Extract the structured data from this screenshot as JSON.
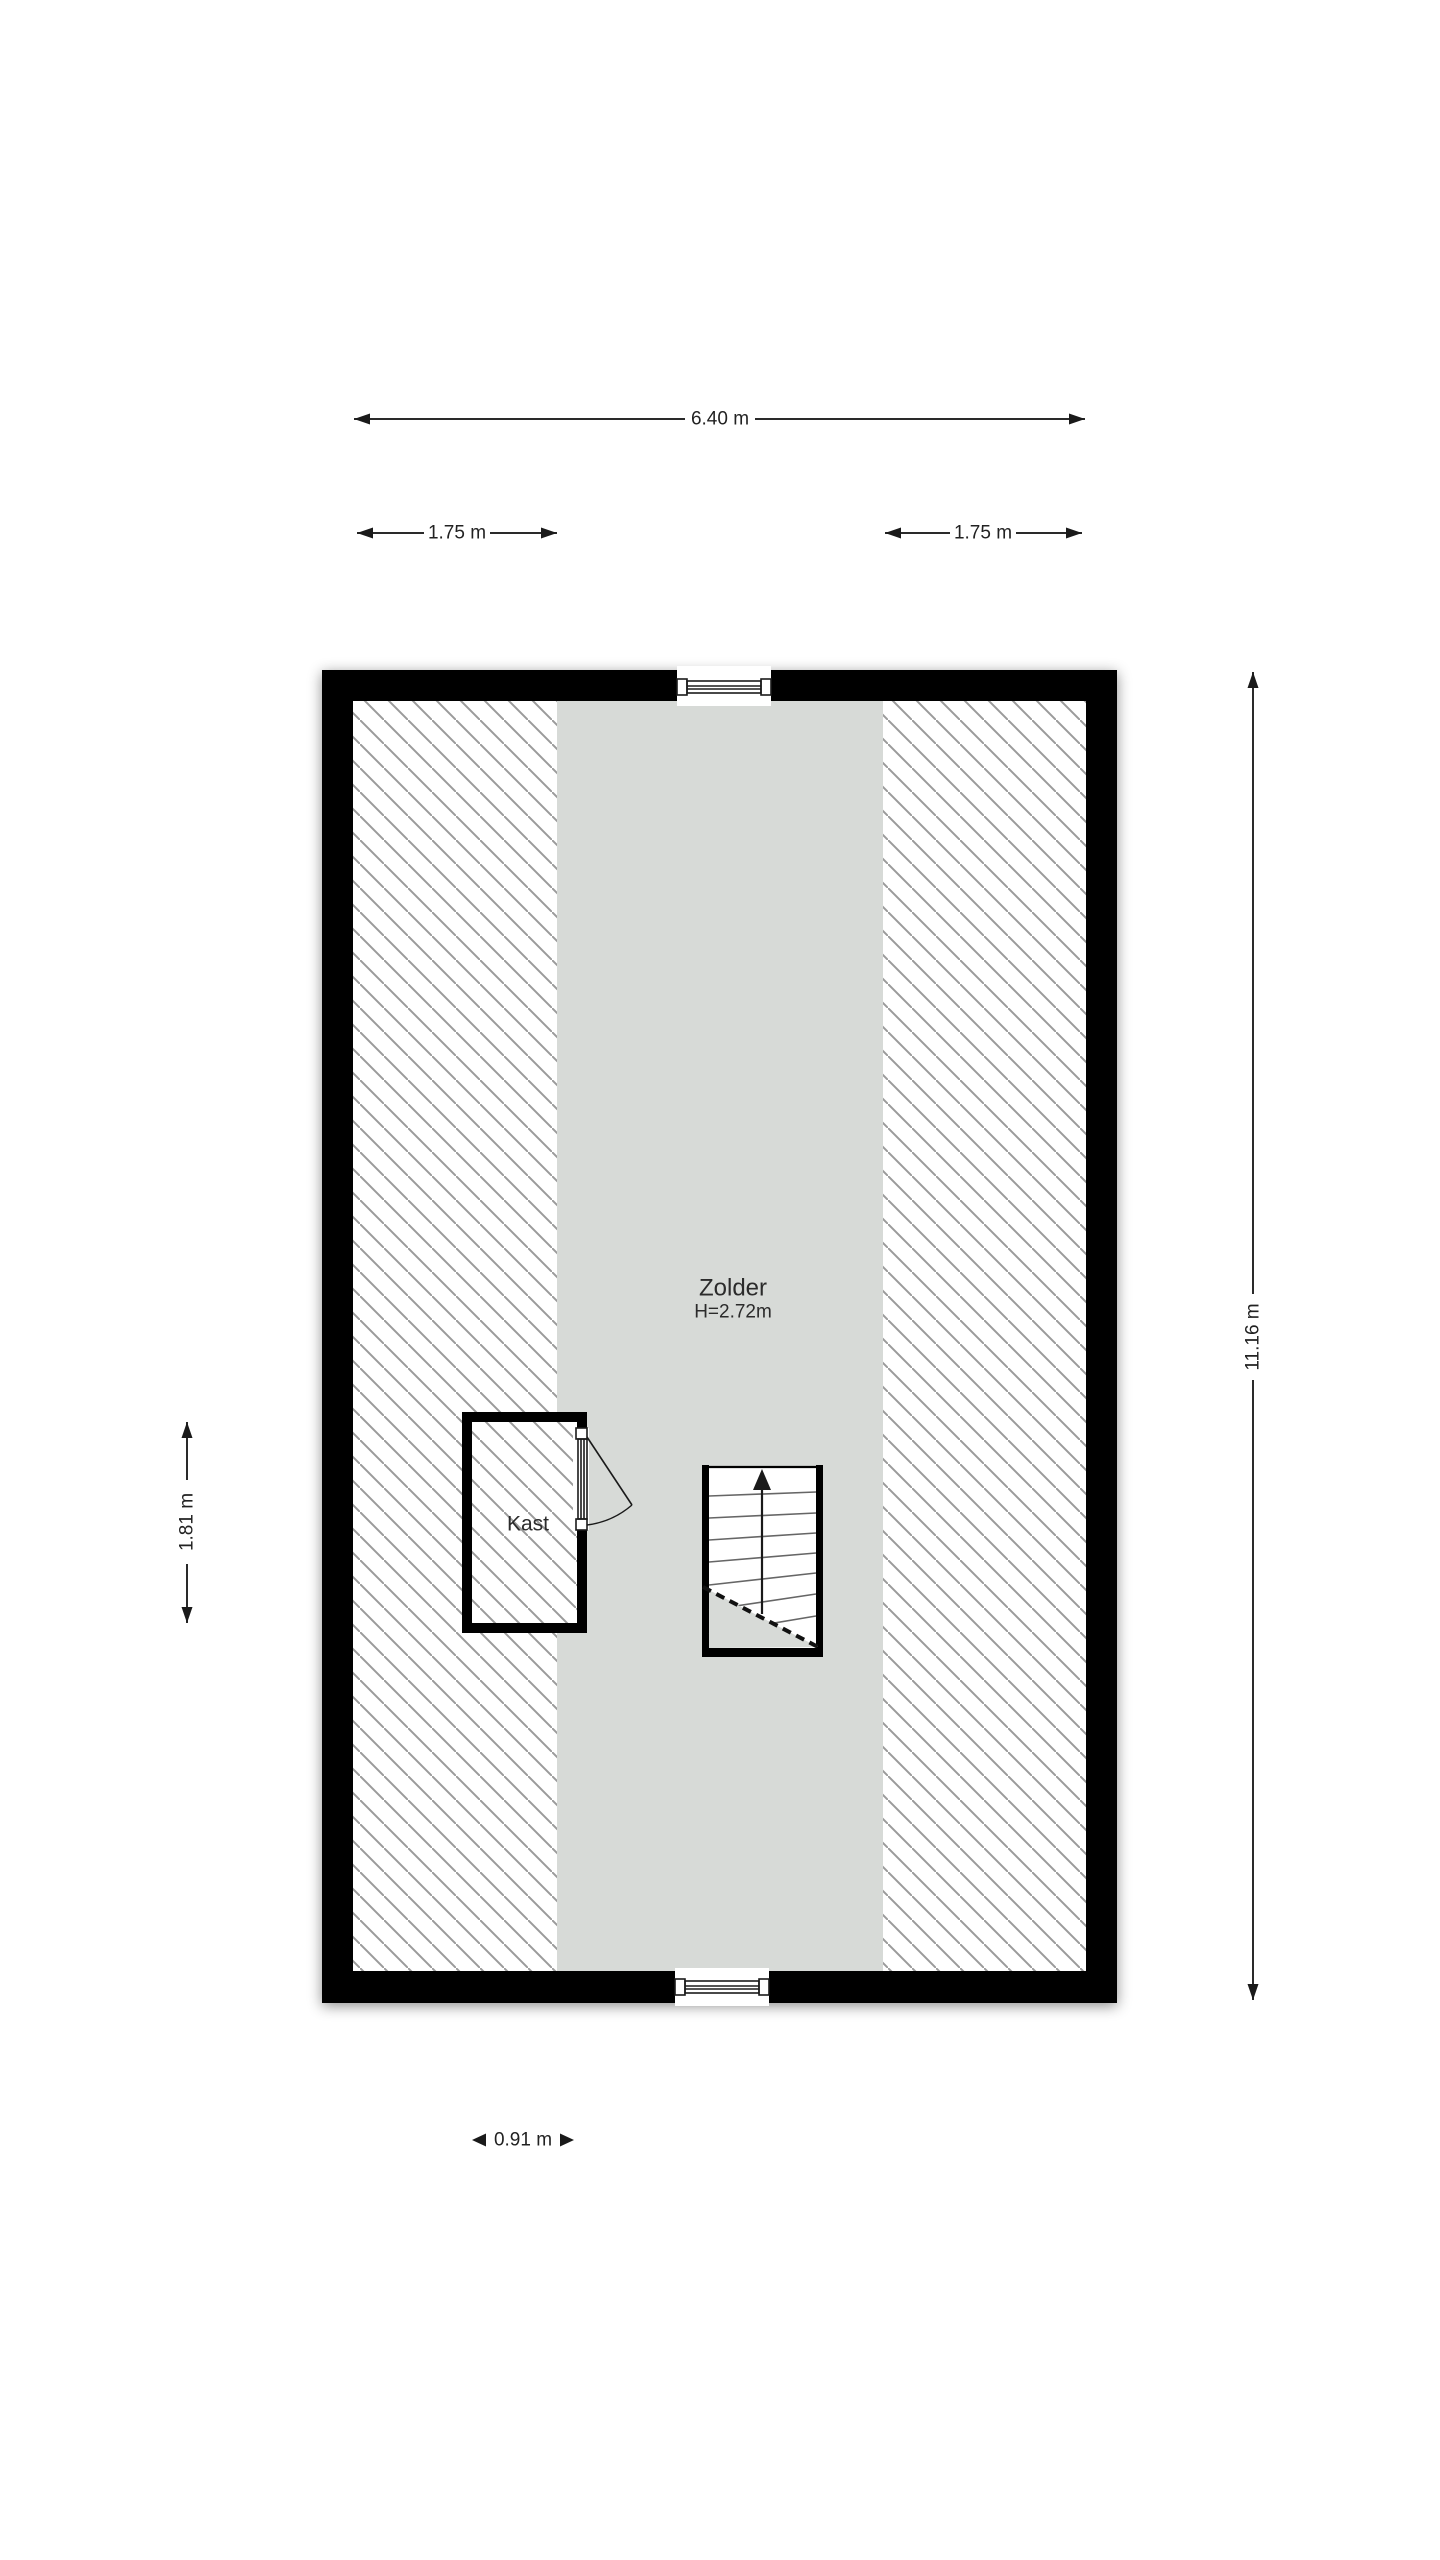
{
  "page": {
    "background": "#ffffff",
    "type_label": "floor-plan"
  },
  "floor_plan": {
    "room": {
      "name": "Zolder",
      "height_label": "H=2.72m"
    },
    "closet": {
      "name": "Kast"
    },
    "stairs": {
      "direction": "up-arrow"
    },
    "dimensions": {
      "total_width": "6.40 m",
      "left_slope_width": "1.75 m",
      "right_slope_width": "1.75 m",
      "total_height": "11.16 m",
      "closet_height": "1.81 m",
      "window_width": "0.91 m"
    },
    "colors": {
      "wall": "#000000",
      "floor": "#d7dad7",
      "hatch_line": "#9b9b9b",
      "dimension_text": "#222222"
    }
  }
}
